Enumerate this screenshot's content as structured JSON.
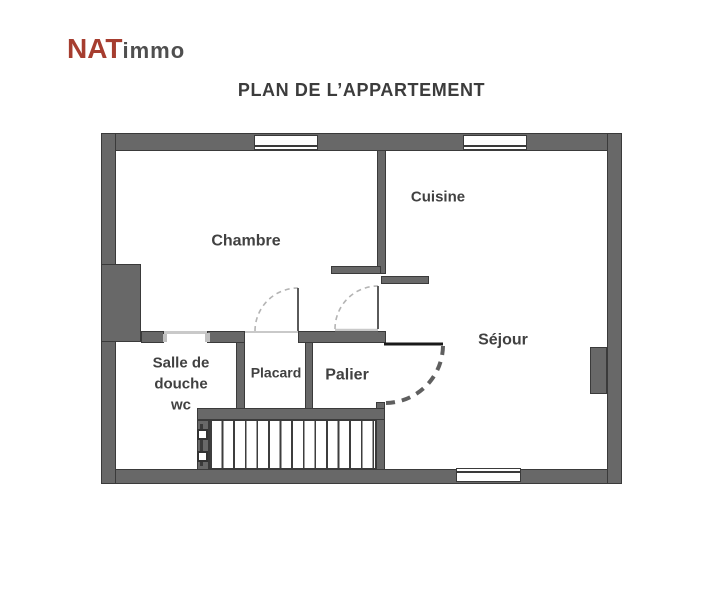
{
  "logo": {
    "brand": "NAT",
    "suffix": "immo"
  },
  "title": "PLAN DE L’APPARTEMENT",
  "rooms": {
    "chambre": "Chambre",
    "cuisine": "Cuisine",
    "sejour": "Séjour",
    "salle_de_douche": "Salle de\ndouche\nwc",
    "placard": "Placard",
    "palier": "Palier"
  },
  "colors": {
    "wall": "#686868",
    "wall_edge": "#3a3a3a",
    "accent_brand": "#a63d2f",
    "text": "#3c3c3c",
    "door_arc_light": "#b4b4b4",
    "door_arc_entrance": "#5f5f5f"
  }
}
